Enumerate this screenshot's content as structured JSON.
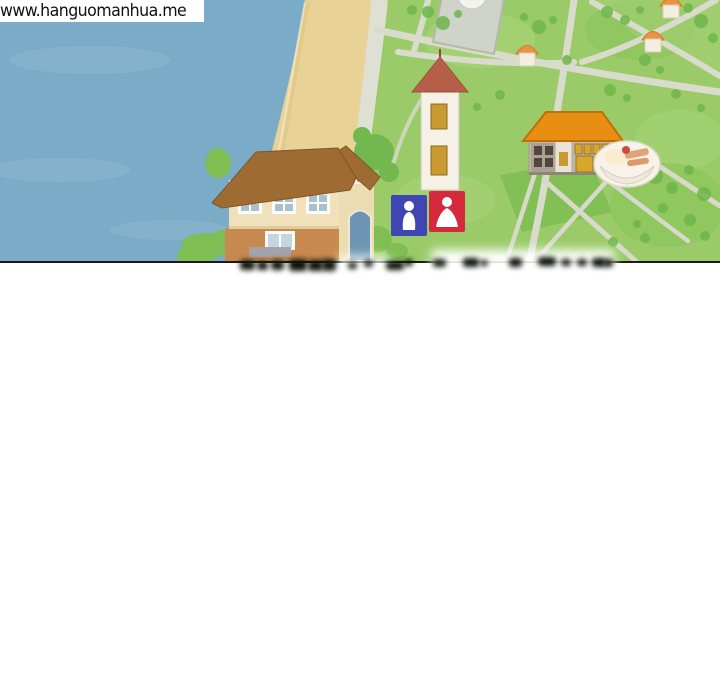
{
  "watermark": {
    "text": "www.hanguomanhua.me"
  },
  "palette": {
    "ocean": "#7AACC7",
    "sand": "#E9D295",
    "grass": "#9BCB69",
    "tree": "#6FB64B",
    "road": "#DEE0D4",
    "roadThin": "#D9DCCC",
    "plaza": "#CFD3C9",
    "houseRoof": "#9E6B33",
    "houseWall": "#F0E1BC",
    "houseBase": "#C8894E",
    "windowBlue": "#A9C1CF",
    "doorBlue": "#6E96B4",
    "towerRoof": "#B65F48",
    "towerWall": "#F5F1E7",
    "amber": "#C89A2F",
    "schoolRoof": "#E88E12",
    "schoolWall": "#BFB5A3",
    "schoolWindow": "#D9A62C",
    "mensBlue": "#3F45B2",
    "womensRed": "#D5293E",
    "smallRoof": "#EC9240",
    "smallWall": "#F3EEDF",
    "bowl": "#F7F3EA",
    "bush": "#7FBE52",
    "panelLine": "#1A1A1A"
  },
  "map": {
    "type": "illustrated-town-map-comic-panel",
    "features": [
      "ocean",
      "beach",
      "coastal-road",
      "grassland",
      "plaza-building",
      "clock-tower",
      "large-house",
      "restroom-sign-men-women",
      "school-building",
      "food-bowl-marker",
      "small-houses",
      "roads",
      "trees",
      "censored-blurred-text"
    ]
  }
}
